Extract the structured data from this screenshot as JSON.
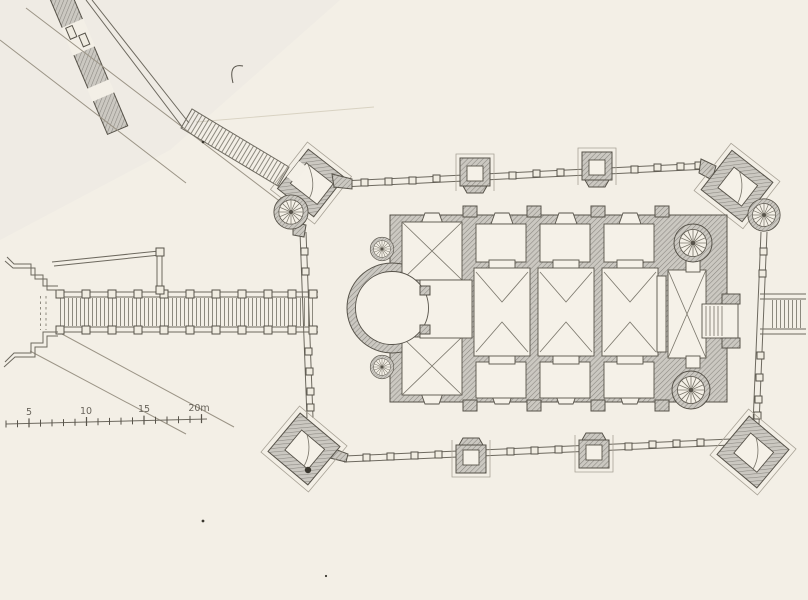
{
  "plan": {
    "subject": "fortified-church-ground-plan",
    "palette": {
      "paper": "#f3efe6",
      "ink": "#57534a",
      "wall_fill": "#cbc8c1",
      "wall_hatch_line": "#8a8780",
      "label_ink": "#514d44",
      "faint_line": "#d8d2c2"
    },
    "scale_bar": {
      "unit": "m",
      "labels": [
        "5",
        "10",
        "15",
        "20m"
      ]
    }
  }
}
